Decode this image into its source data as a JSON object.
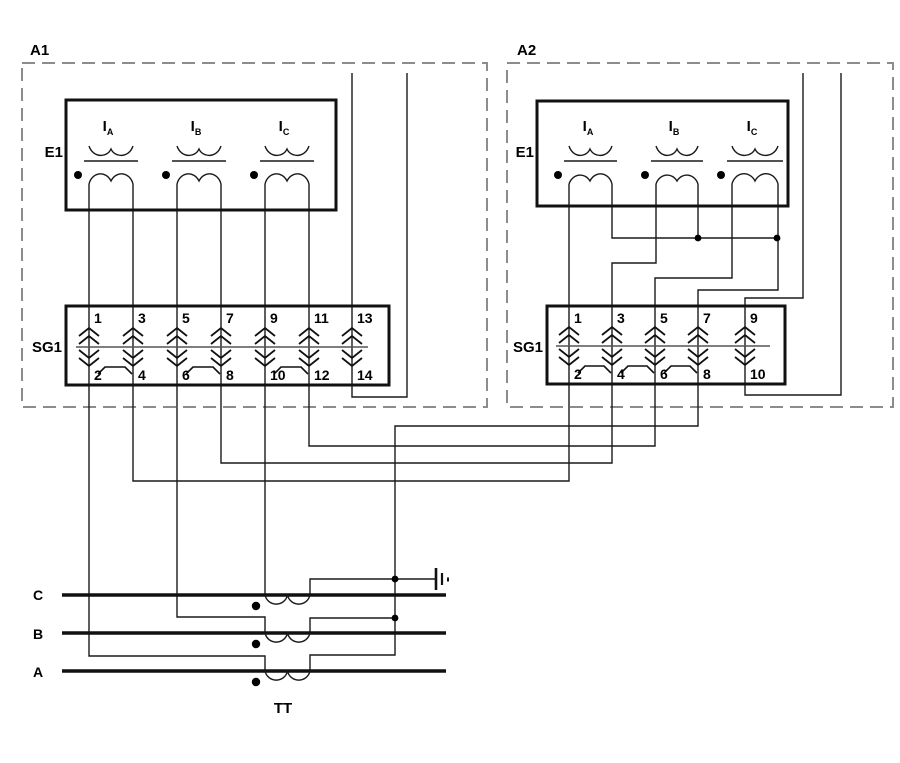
{
  "devices": {
    "a1": {
      "label": "A1",
      "relay_label": "E1",
      "terminal_block_label": "SG1",
      "coils": [
        {
          "main": "I",
          "sub": "A"
        },
        {
          "main": "I",
          "sub": "B"
        },
        {
          "main": "I",
          "sub": "C"
        }
      ],
      "sg1_top": [
        "1",
        "3",
        "5",
        "7",
        "9",
        "11",
        "13"
      ],
      "sg1_bottom": [
        "2",
        "4",
        "6",
        "8",
        "10",
        "12",
        "14"
      ]
    },
    "a2": {
      "label": "A2",
      "relay_label": "E1",
      "terminal_block_label": "SG1",
      "coils": [
        {
          "main": "I",
          "sub": "A"
        },
        {
          "main": "I",
          "sub": "B"
        },
        {
          "main": "I",
          "sub": "C"
        }
      ],
      "sg1_top": [
        "1",
        "3",
        "5",
        "7",
        "9"
      ],
      "sg1_bottom": [
        "2",
        "4",
        "6",
        "8",
        "10"
      ]
    }
  },
  "bus": {
    "phases": [
      "C",
      "B",
      "A"
    ],
    "ct_group_label": "TT"
  },
  "colors": {
    "line": "#1a1a1a",
    "boundary_dash": "#8c8c8c",
    "background": "#ffffff"
  }
}
